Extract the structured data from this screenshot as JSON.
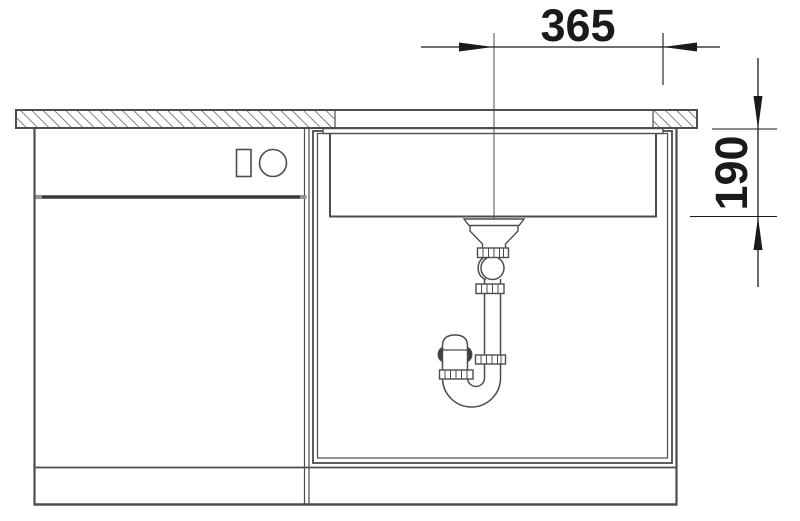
{
  "drawing": {
    "title": "undermount-sink-installation-side-view",
    "dim_width": "365",
    "dim_depth": "190",
    "parts": [
      "countertop-section",
      "undermount-sink-bowl",
      "drain-strainer",
      "siphon-p-trap",
      "base-cabinet",
      "appliance-front-controls"
    ]
  },
  "colors": {
    "background": "#ffffff",
    "line": "#4d4d4d",
    "dimension": "#1a1a1a"
  }
}
